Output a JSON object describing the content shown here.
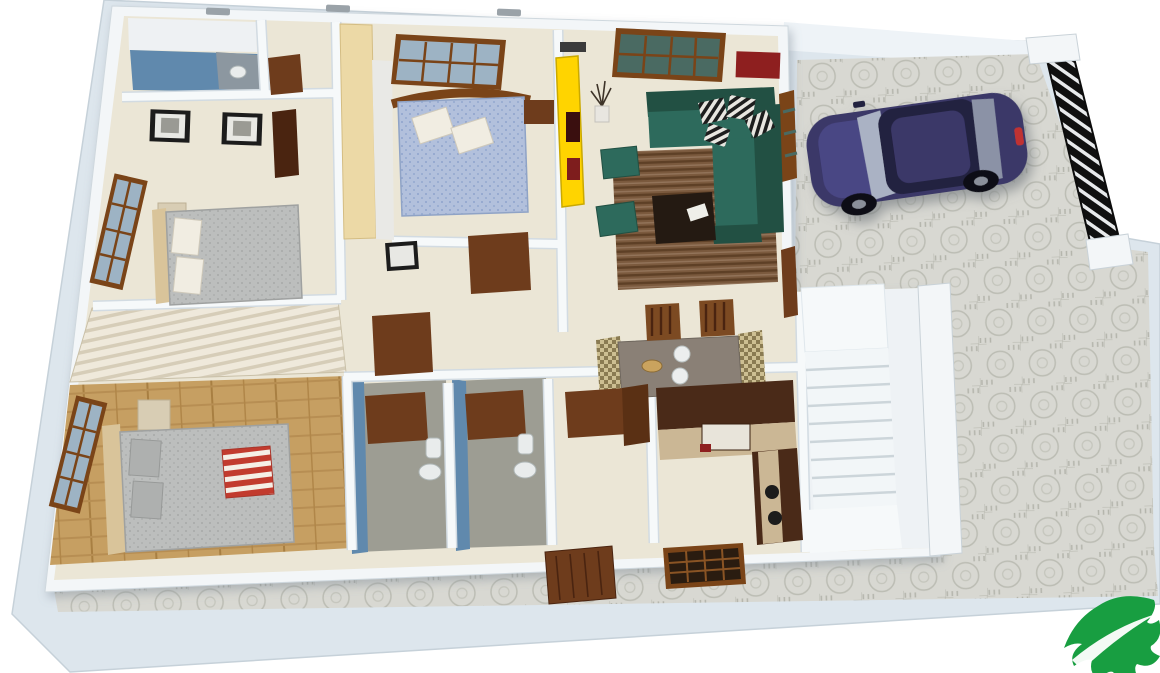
{
  "scene": {
    "type": "3d-floorplan-render",
    "description": "Isometric 3D rendered floor plan of a single-storey house with attached open car parking, white boundary wall and stone-paved yard",
    "rooms": [
      {
        "name": "bathroom-top-left",
        "features": [
          "blue-floor",
          "shower-corner",
          "wash-basin",
          "door"
        ]
      },
      {
        "name": "bedroom-left",
        "features": [
          "double-bed-gray",
          "white-pillows",
          "side-table",
          "two-wall-frames",
          "wood-window",
          "wardrobe"
        ]
      },
      {
        "name": "bedroom-top-center",
        "features": [
          "double-bed-blue",
          "arched-headboard",
          "white-pillows",
          "wood-window",
          "beige-wardrobe",
          "yellow-cabinet"
        ]
      },
      {
        "name": "living-room",
        "features": [
          "teal-l-shaped-sofa",
          "patterned-cushions",
          "two-teal-ottomans",
          "striped-rug",
          "dark-coffee-table",
          "dry-plant-vase",
          "wood-window",
          "red-wall-panel"
        ]
      },
      {
        "name": "hallway",
        "features": [
          "wall-frame",
          "two-wood-doors"
        ]
      },
      {
        "name": "dining-area",
        "features": [
          "dining-table",
          "slat-back-chairs",
          "plates",
          "fruit-bowl",
          "patterned-runners"
        ]
      },
      {
        "name": "master-bedroom",
        "features": [
          "wood-plank-floor",
          "double-bed-gray",
          "red-striped-throw",
          "bedside-cube",
          "wood-window",
          "slatted-partition-wall"
        ]
      },
      {
        "name": "bathroom-bottom-left",
        "features": [
          "blue-wall",
          "gray-floor",
          "toilet",
          "wash-basin",
          "door"
        ]
      },
      {
        "name": "bathroom-bottom-right",
        "features": [
          "blue-wall",
          "gray-floor",
          "toilet",
          "wash-basin",
          "door"
        ]
      },
      {
        "name": "utility-lobby",
        "features": [
          "door",
          "cabinet"
        ]
      },
      {
        "name": "kitchen",
        "features": [
          "l-shaped-counter",
          "dark-cabinets",
          "beige-countertop",
          "hob-burners",
          "oven"
        ]
      },
      {
        "name": "staircase",
        "features": [
          "white-landing",
          "descending-steps",
          "side-wall"
        ]
      },
      {
        "name": "car-parking",
        "features": [
          "paver-stone-floor",
          "navy-sedan-car",
          "black-slatted-gate"
        ]
      }
    ],
    "exterior": [
      "white-boundary-wall",
      "stone-paved-pathway",
      "front-door",
      "lattice-vent-window",
      "roof-vent-caps"
    ],
    "logo": {
      "name": "green-leaf-logo",
      "position": "bottom-right"
    }
  },
  "colors": {
    "background": "#ffffff",
    "platform": "#dde6ed",
    "wall": "#f3f6f8",
    "wall_shade": "#d2dbe2",
    "floor": "#ebe6d6",
    "bath_blue": "#6089ad",
    "bath_floor": "#9d9d93",
    "stone": "#d8d8d2",
    "stone_line": "#b9bab1",
    "wood_floor": "#c69f62",
    "slat_light": "#efe9db",
    "slat_dark": "#d6cdb8",
    "sofa": "#2d6a5c",
    "sofa_dark": "#225043",
    "rug": "#7b5a3e",
    "rug_stripe": "#5e4026",
    "coffee_table": "#241a12",
    "yellow_cabinet": "#ffd400",
    "red_panel": "#8e1f1f",
    "bed_gray": "#bcbebd",
    "bed_blue": "#aebdd9",
    "pillow": "#f1ede2",
    "throw_red": "#c23b2e",
    "door": "#6e3c1c",
    "door_dark": "#4a2410",
    "window_frame": "#7a4418",
    "glass": "#9db3c4",
    "headboard_beige": "#d9c49a",
    "wardrobe_beige": "#ecd9a6",
    "kitchen_cabinet": "#4a2a18",
    "counter": "#cbb795",
    "table": "#8a8076",
    "chair": "#7c4a22",
    "car_body": "#3a3768",
    "car_roof": "#23203f",
    "car_glass": "#aab2c4",
    "gate_black": "#101010",
    "leaf_green": "#189e41",
    "basin_white": "#e9ecec"
  }
}
